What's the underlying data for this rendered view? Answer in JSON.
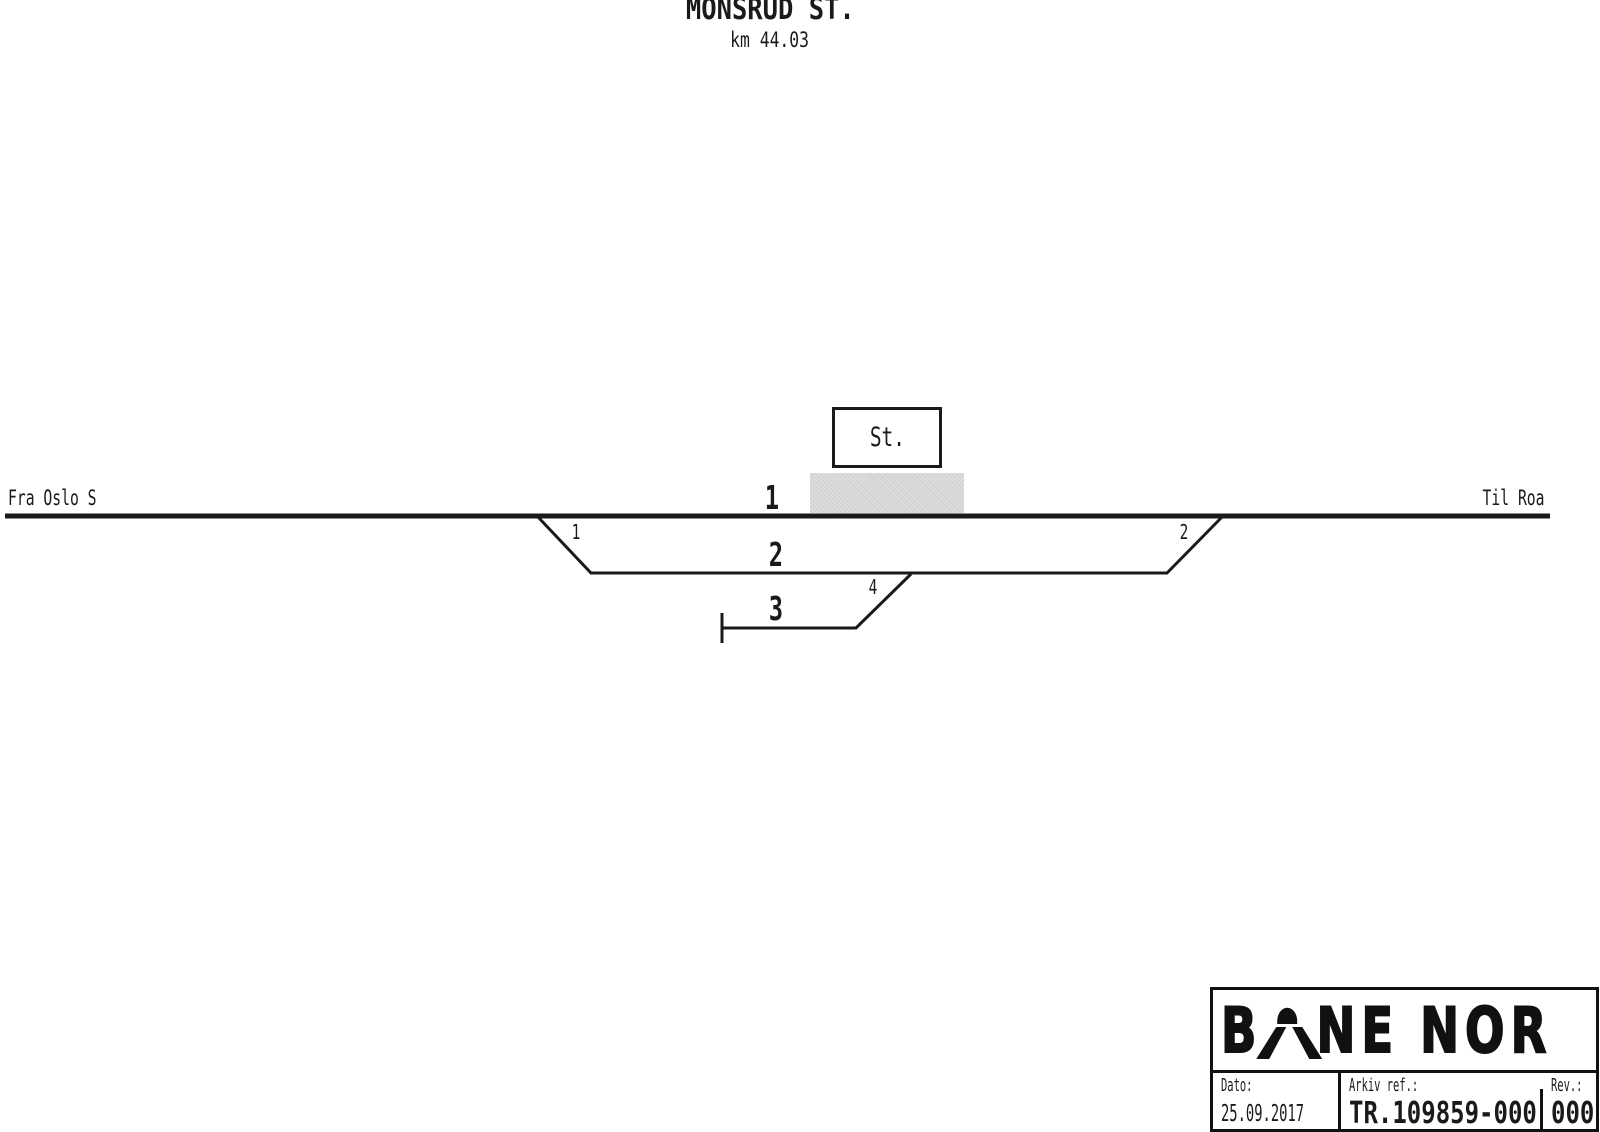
{
  "header": {
    "title": "MONSRUD ST.",
    "km": "km 44.03"
  },
  "diagram": {
    "from_label": "Fra Oslo S",
    "to_label": "Til Roa",
    "station_abbrev": "St.",
    "tracks": [
      {
        "number": "1"
      },
      {
        "number": "2"
      },
      {
        "number": "3"
      }
    ],
    "switches": [
      {
        "number": "1"
      },
      {
        "number": "2"
      },
      {
        "number": "4"
      }
    ]
  },
  "title_block": {
    "logo": {
      "part1": "B",
      "part2": "NE",
      "part3": "NOR",
      "symbol": "tunnel-arch"
    },
    "fields": [
      {
        "label": "Dato:",
        "value": "25.09.2017"
      },
      {
        "label": "Arkiv ref.:",
        "value": "TR.109859-000"
      },
      {
        "label": "Rev.:",
        "value": "000"
      }
    ]
  },
  "colors": {
    "line": "#1a1a1a",
    "platform": "#d3d3d3",
    "background": "#ffffff",
    "logo": "#111111"
  }
}
